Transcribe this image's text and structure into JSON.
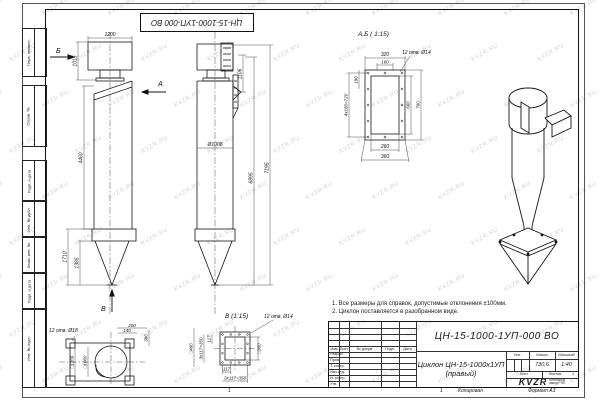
{
  "sheet": {
    "watermark": "KVZR.RU",
    "top_stamp": "ЦН-15-1000-1УП-000 ВО",
    "side_fields": {
      "perv": "Перв. примен.",
      "sprav": "Справ. №",
      "podp1": "Подп. и дата",
      "inv_dubl": "Инв. № дубл.",
      "vzam": "Взам. инв. №",
      "podp2": "Подп. и дата",
      "inv_podl": "Инв. № подл."
    },
    "bottom": {
      "mark": "1",
      "copied": "Копировал",
      "format": "Формат А3"
    }
  },
  "notes": {
    "line1": "1. Все размеры для справок, допустимые отклонения ±100мм.",
    "line2": "2. Циклон поставляется в разобранном виде."
  },
  "front_view": {
    "label_b": "Б",
    "label_a": "А",
    "label_v": "В",
    "dim_width": "1200",
    "dim_box_height": "1015",
    "dim_body_height": "4460",
    "dim_cone": "1710",
    "dim_cone_inner": "1385"
  },
  "side_view": {
    "dim_diameter": "Ø1008",
    "dim_flange": "1106",
    "dim_h1": "6895",
    "dim_h2": "7195"
  },
  "section_ab": {
    "title": "А,Б ( 1:15)",
    "holes": "12 отв. Ø14",
    "dim_320": "320",
    "dim_160": "160",
    "dim_190": "190",
    "dim_pitch": "4x180=720",
    "dim_660": "660",
    "dim_760": "760",
    "dim_260": "260",
    "dim_360": "360"
  },
  "bottom_flange": {
    "holes": "12 отв. Ø18",
    "dim_200": "200",
    "dim_140": "140",
    "dim_380": "380",
    "dim_sq_outer": "□1206",
    "dim_sq_bolts": "□1060"
  },
  "section_v": {
    "title": "В (1:15)",
    "holes": "12 отв. Ø14",
    "dim_sq460": "□460",
    "dim_pitch_l": "3x117=350",
    "dim_117_l": "117",
    "dim_sq300": "□300",
    "dim_117_b": "117",
    "dim_pitch_b": "3x117=350"
  },
  "title_block": {
    "doc_number": "ЦН-15-1000-1УП-000 ВО",
    "product_title": "Циклон ЦН-15-1000х1УП",
    "product_subtitle": "(правый)",
    "col_izm": "Изм",
    "col_list": "Лист",
    "col_doc": "№ докум.",
    "col_podp": "Подп.",
    "col_data": "Дата",
    "rows": {
      "r1": "Разраб.",
      "r2": "Пров.",
      "r3": "Т. контр.",
      "r4": "Нач.отд.",
      "r5": "Н. контр.",
      "r6": "Утв."
    },
    "lit_label": "Лит.",
    "mass_label": "Масса",
    "scale_label": "Масштаб",
    "mass_value": "730,6",
    "scale_value": "1:40",
    "sheet_label": "Лист",
    "sheets_label": "Листов",
    "sheets_value": "1",
    "logo": "KVZR",
    "logo_caption_1": "Котельный",
    "logo_caption_2": "завод РЭП"
  }
}
